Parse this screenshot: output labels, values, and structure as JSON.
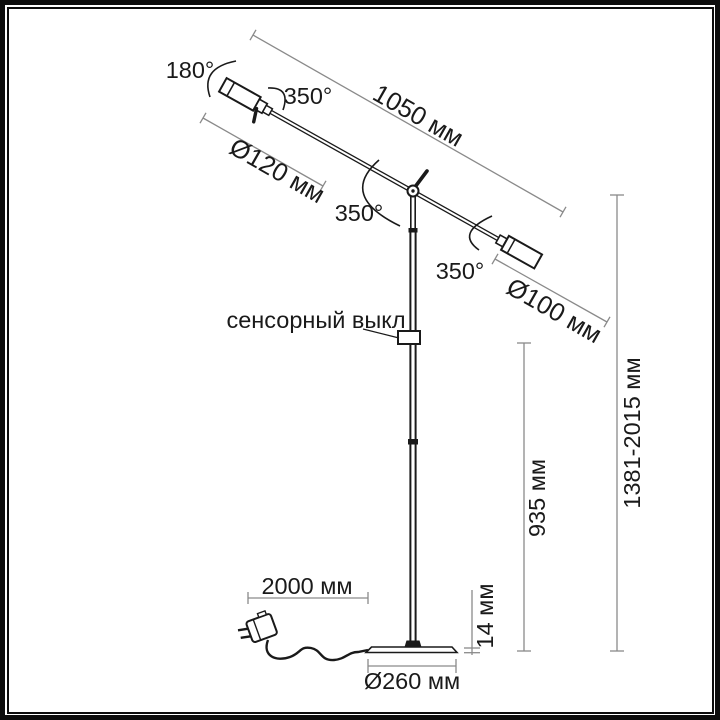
{
  "labels": {
    "rotation_180": "180°",
    "swivel_left": "350°",
    "swivel_pivot": "350°",
    "swivel_right": "350°",
    "arm_length": "1050 мм",
    "left_head_diameter": "Ø120 мм",
    "right_head_diameter": "Ø100 мм",
    "touch_switch": "сенсорный выкл",
    "total_height_range": "1381-2015 мм",
    "lower_pole_height": "935 мм",
    "base_thickness": "14 мм",
    "cable_length": "2000 мм",
    "base_diameter": "Ø260 мм"
  },
  "colors": {
    "line": "#1a1a1a",
    "dim": "#8a8a8a",
    "background": "#ffffff",
    "frame": "#0d0d0d"
  }
}
